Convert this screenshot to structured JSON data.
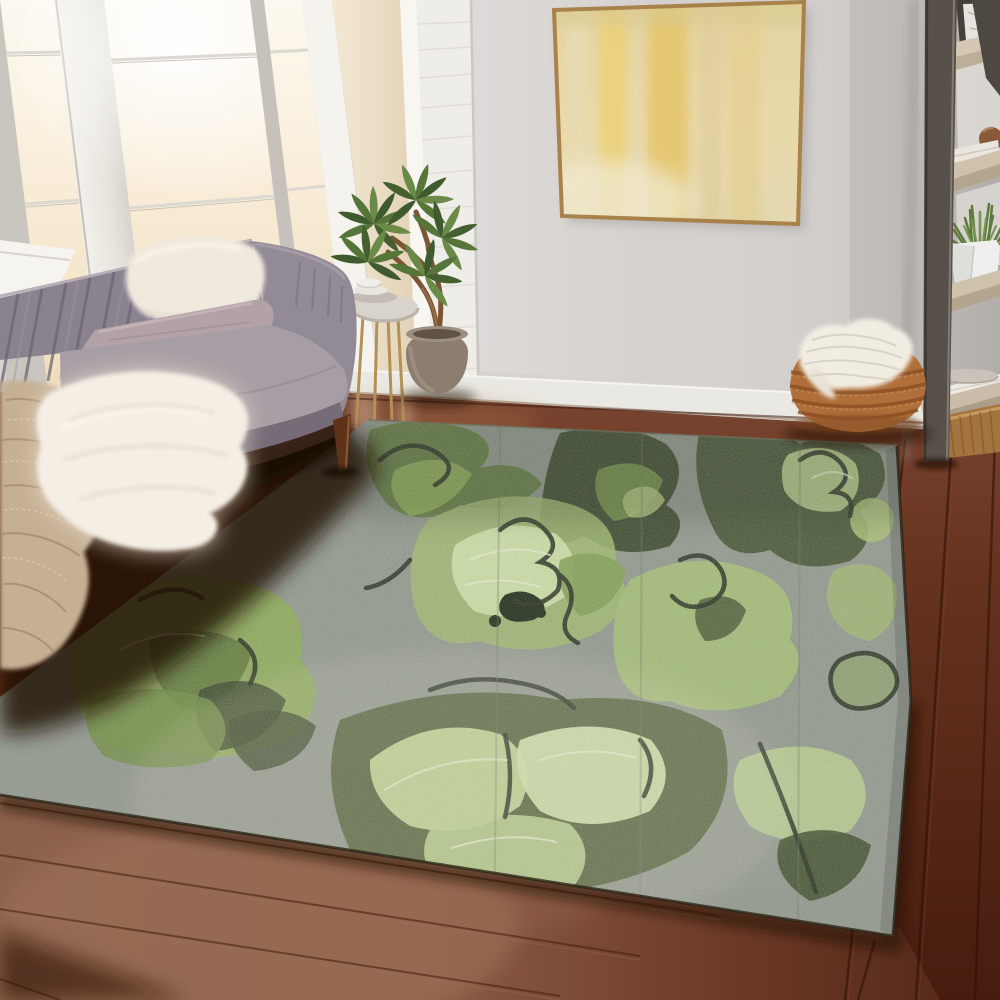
{
  "alt": "Living room product photo: green abstract floral area rug on dark hardwood floor, gray channel-tufted sofa with throws, sunlit windows, gold abstract wall art, leaning ladder shelf with decor, and a woven basket with a chunky knit blanket",
  "labels": {
    "scene": "Living room with green abstract floral area rug",
    "window": "Sunlit window wall with white frames",
    "column": "White plaster brick column",
    "wall": "Light gray wall",
    "painting": "Gold abstract canvas in thin gold frame",
    "baseboard": "White baseboard",
    "floor": "Dark walnut hardwood floor",
    "rug": "Green abstract floral area rug",
    "sofa": "Gray channel-tufted velvet sofa",
    "fur_pillow": "Cream faux-fur pillow",
    "mauve_pillow": "Mauve lumbar pillow",
    "fur_throw": "White faux-fur throw",
    "knit_throw": "Beige knit throw blanket",
    "sofa_leg": "Tapered wood sofa leg",
    "table": "Round side table with gold wire legs",
    "dishes": "Stacked plates and bowl",
    "plant": "Potted faux tree in taupe pot",
    "shelf": "Dark leaning ladder shelf",
    "shelf_art": "Framed marble art print",
    "shelf_ball": "Wooden decorative sphere",
    "shelf_towels": "Folded white towels",
    "shelf_plant": "Greenery in white geometric pot",
    "shelf_plate": "Ceramic plate on book stack",
    "rattan_box": "Rattan storage box",
    "basket": "Woven seagrass basket",
    "basket_blanket": "Chunky white knit blanket"
  },
  "palette": {
    "wall": "#d6d3d0",
    "window-glow": "#f8eedb",
    "frame-white": "#edebe6",
    "column-white": "#efede8",
    "painting-gold": "#e5c87d",
    "painting-cream": "#eadfb6",
    "frame-gold": "#a8824a",
    "baseboard": "#eae8e2",
    "sofa-gray": "#8b8290",
    "sofa-seat": "#a79ea5",
    "pillow-fur": "#f0e9de",
    "pillow-mauve": "#b2a1a6",
    "throw-fur": "#f4eee4",
    "throw-knit": "#c6b094",
    "floor-light": "#8a5f49",
    "floor-dark": "#4e2012",
    "rug-gray": "#8e948c",
    "rug-lime": "#8fae53",
    "rug-olive": "#5a7434",
    "rug-forest": "#2c3a1e",
    "rug-pale": "#cfe0a8",
    "rug-charcoal": "#20281a",
    "shelf-frame": "#57504b",
    "shelf-wood": "#c9bca8",
    "basket-rust": "#b06f3a",
    "blanket-white": "#f2ede3",
    "plant-green": "#44602f",
    "pot-taupe": "#8b7d6f",
    "table-gold": "#b39055",
    "wood-leg": "#6b3d22"
  }
}
